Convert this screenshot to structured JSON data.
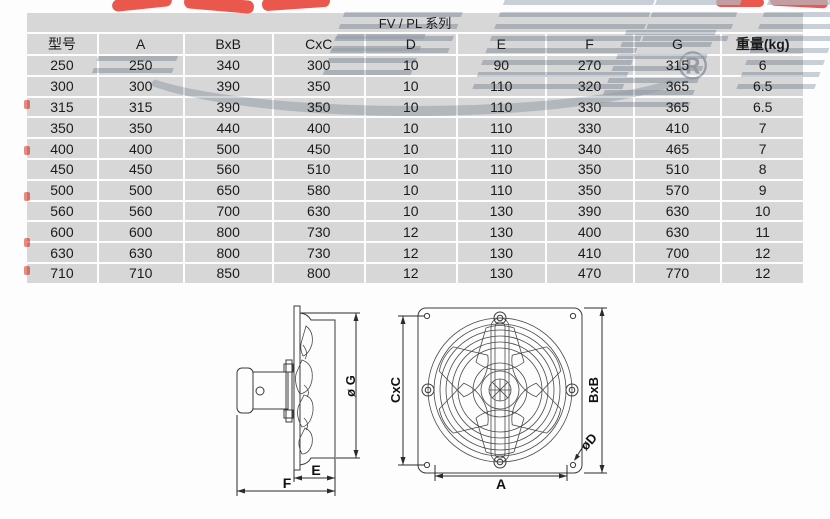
{
  "title": "FV / PL 系列",
  "watermark": {
    "registered": "®"
  },
  "colors": {
    "cell_gray": "#d9d9d9",
    "watermark_gray": "#b2bbc5",
    "watermark_red": "#e6392e",
    "line_color": "#3a3a3a"
  },
  "table": {
    "headers": [
      "型号",
      "A",
      "BxB",
      "CxC",
      "D",
      "E",
      "F",
      "G",
      "重量(kg)"
    ],
    "rows": [
      [
        "250",
        "250",
        "340",
        "300",
        "10",
        "90",
        "270",
        "315",
        "6"
      ],
      [
        "300",
        "300",
        "390",
        "350",
        "10",
        "110",
        "320",
        "365",
        "6.5"
      ],
      [
        "315",
        "315",
        "390",
        "350",
        "10",
        "110",
        "330",
        "365",
        "6.5"
      ],
      [
        "350",
        "350",
        "440",
        "400",
        "10",
        "110",
        "330",
        "410",
        "7"
      ],
      [
        "400",
        "400",
        "500",
        "450",
        "10",
        "110",
        "340",
        "465",
        "7"
      ],
      [
        "450",
        "450",
        "560",
        "510",
        "10",
        "110",
        "350",
        "510",
        "8"
      ],
      [
        "500",
        "500",
        "650",
        "580",
        "10",
        "110",
        "350",
        "570",
        "9"
      ],
      [
        "560",
        "560",
        "700",
        "630",
        "10",
        "130",
        "390",
        "630",
        "10"
      ],
      [
        "600",
        "600",
        "800",
        "730",
        "12",
        "130",
        "400",
        "630",
        "11"
      ],
      [
        "630",
        "630",
        "800",
        "730",
        "12",
        "130",
        "410",
        "700",
        "12"
      ],
      [
        "710",
        "710",
        "850",
        "800",
        "12",
        "130",
        "470",
        "770",
        "12"
      ]
    ]
  },
  "drawings": {
    "side_view": {
      "dim_g": "ø G",
      "dim_e": "E",
      "dim_f": "F"
    },
    "front_view": {
      "dim_cxc": "CxC",
      "dim_bxb": "BxB",
      "dim_a": "A",
      "dim_d": "øD"
    }
  }
}
